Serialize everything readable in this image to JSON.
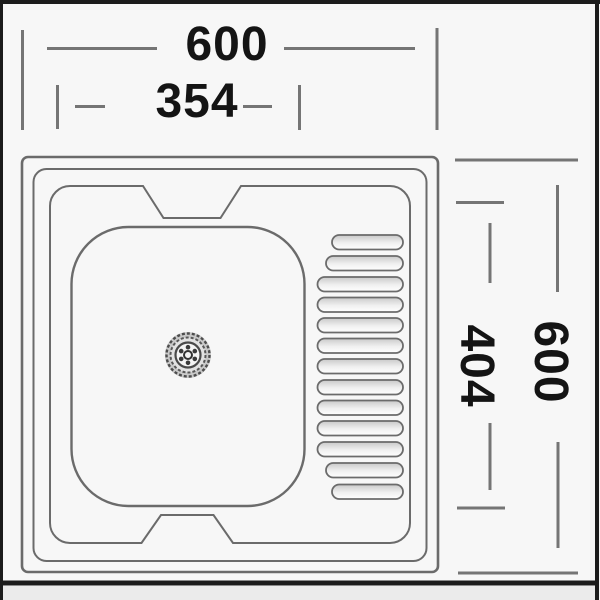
{
  "dimensions": {
    "overall_width": "600",
    "bowl_width": "354",
    "overall_height": "600",
    "bowl_height": "404"
  },
  "colors": {
    "background": "#f7f7f7",
    "outside_strip": "#ebebeb",
    "frame": "#1c1c1c",
    "drawing_line": "#6b6b6b",
    "dimension_line": "#757575",
    "text": "#141414"
  }
}
